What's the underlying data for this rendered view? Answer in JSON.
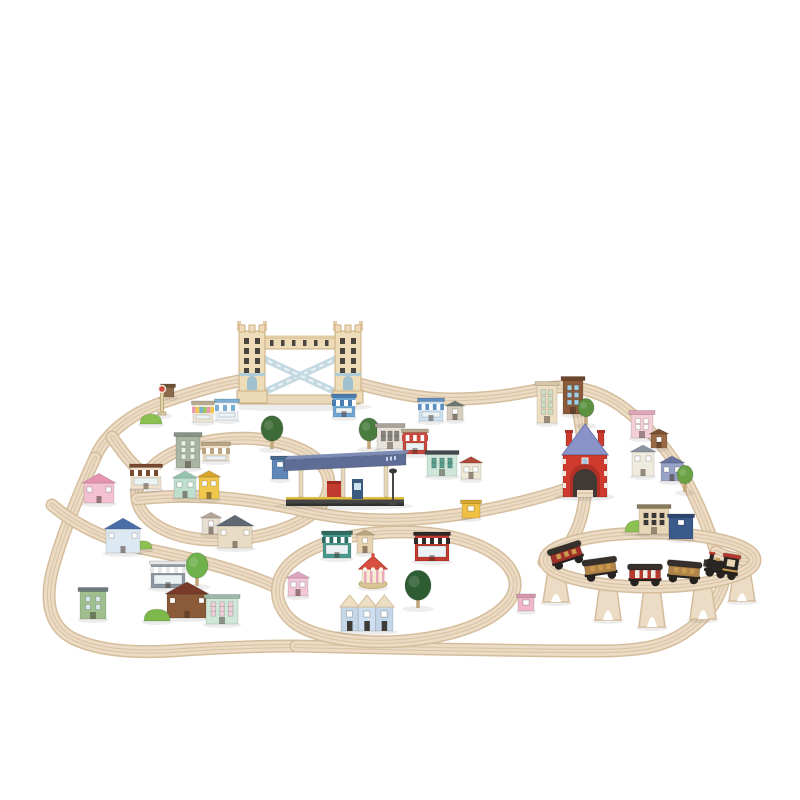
{
  "background": "#ffffff",
  "palette": {
    "background": "#ffffff",
    "track_base": "#ecdcc5",
    "track_edge": "#d5bd9c",
    "track_groove": "#dcc6a8",
    "shadow": "rgba(0,0,0,0.07)",
    "bridge_cream": "#eedbb8",
    "bridge_trim": "#c9ae82",
    "bridge_blue": "#aeccd6",
    "bascule_blue": "#c5d9e2",
    "station_red": "#ce3a2e",
    "station_red_dark": "#b02f26",
    "station_roof_blue": "#8a93c8",
    "platform_canopy": "#5d6d95",
    "platform_canopy_top": "#7c8cb4",
    "platform_base": "#454545",
    "platform_stripe": "#e2bc3c",
    "train_black": "#2a2623",
    "train_red": "#b5392e",
    "train_gold": "#c89b4e",
    "window_dark": "#4a4440",
    "foliage_light": "#8cc152"
  },
  "scene": {
    "canvas": {
      "width": 800,
      "height": 800
    },
    "tracks": [
      {
        "n": "top-left-curve",
        "d": "M 95 458 C 104 436 128 414 164 402 C 198 390 228 382 252 379"
      },
      {
        "n": "top-right-run",
        "d": "M 348 381 C 388 392 420 399 452 399 C 498 399 524 392 548 388 C 574 384 598 391 618 404 C 648 425 669 451 684 477 C 698 502 708 527 716 552"
      },
      {
        "n": "left-outer-loop",
        "d": "M 95 458 C 82 486 62 534 52 572 C 45 602 50 626 72 638 C 98 651 134 653 170 651 C 214 648 254 646 296 646"
      },
      {
        "n": "bottom-run",
        "d": "M 296 646 C 390 648 500 651 598 651 C 642 651 664 646 684 633 C 704 620 716 604 722 587 C 727 571 724 559 716 552"
      },
      {
        "n": "right-connector",
        "d": "M 716 552 C 724 556 736 560 747 560"
      },
      {
        "n": "inner-left-loop",
        "d": "M 146 474 C 170 442 236 430 286 444 C 320 454 336 474 326 497 C 314 524 262 541 212 540 C 168 539 140 520 137 499 C 135 489 139 481 146 474 Z"
      },
      {
        "n": "middle-run",
        "d": "M 137 499 C 200 492 258 500 305 511 C 362 524 420 521 468 513 C 514 505 546 496 567 489"
      },
      {
        "n": "junction-curve",
        "d": "M 112 437 C 122 452 130 462 140 471"
      },
      {
        "n": "left-diagonal",
        "d": "M 52 505 C 75 525 110 542 150 550 C 200 560 245 572 278 588"
      },
      {
        "n": "bottom-oval",
        "d": "M 278 585 C 282 556 330 534 392 532 C 452 530 504 548 514 577 C 522 602 488 628 428 638 C 372 647 308 640 288 617 C 280 608 276 597 278 585 Z"
      },
      {
        "n": "station-climb",
        "d": "M 585 470 C 585 452 581 420 575 396"
      },
      {
        "n": "station-descent",
        "d": "M 585 497 C 583 515 578 532 568 545 C 560 555 551 561 544 562"
      },
      {
        "n": "elevated-loop",
        "raised": true,
        "d": "M 545 560 a 105 27 0 1 0 210 0 a 105 27 0 1 0 -210 0"
      }
    ],
    "items": [
      {
        "t": "riser",
        "n": "track-riser",
        "x": 556,
        "y": 602,
        "h": 32
      },
      {
        "t": "riser",
        "n": "track-riser",
        "x": 608,
        "y": 620,
        "h": 38
      },
      {
        "t": "riser",
        "n": "track-riser",
        "x": 652,
        "y": 627,
        "h": 40
      },
      {
        "t": "riser",
        "n": "track-riser",
        "x": 703,
        "y": 619,
        "h": 36
      },
      {
        "t": "riser",
        "n": "track-riser",
        "x": 742,
        "y": 601,
        "h": 31
      },
      {
        "t": "bridge",
        "n": "tower-bridge",
        "x": 300,
        "y": 403
      },
      {
        "t": "redstation",
        "n": "red-tunnel-station",
        "x": 585,
        "y": 497
      },
      {
        "t": "platform",
        "n": "station-platform",
        "x": 344,
        "y": 506
      },
      {
        "t": "carousel",
        "n": "bandstand",
        "x": 373,
        "y": 587
      },
      {
        "t": "rowhouses",
        "n": "terrace-houses",
        "x": 367,
        "y": 631
      },
      {
        "t": "signal",
        "n": "rail-signal",
        "x": 162,
        "y": 415
      },
      {
        "t": "tree",
        "n": "tree",
        "x": 272,
        "y": 449,
        "r": 11,
        "c1": "#3e6b37"
      },
      {
        "t": "tree",
        "n": "tree",
        "x": 369,
        "y": 449,
        "r": 10,
        "c1": "#497c3e"
      },
      {
        "t": "tree",
        "n": "tree",
        "x": 418,
        "y": 608,
        "r": 13,
        "c1": "#2e5d33"
      },
      {
        "t": "tree",
        "n": "tree",
        "x": 586,
        "y": 425,
        "r": 8,
        "c1": "#5b9141"
      },
      {
        "t": "tree",
        "n": "tree",
        "x": 685,
        "y": 492,
        "r": 8,
        "c1": "#6ba245"
      },
      {
        "t": "tree",
        "n": "round-tree",
        "x": 197,
        "y": 586,
        "r": 11,
        "c1": "#6fb14b"
      },
      {
        "t": "bush",
        "n": "bush",
        "x": 151,
        "y": 424,
        "w": 22,
        "c1": "#8cc152"
      },
      {
        "t": "bush",
        "n": "bush",
        "x": 157,
        "y": 621,
        "w": 26,
        "c1": "#7cb84a"
      },
      {
        "t": "bush",
        "n": "bush",
        "x": 638,
        "y": 532,
        "w": 26,
        "c1": "#8cc152"
      },
      {
        "t": "bush",
        "n": "bush",
        "x": 143,
        "y": 549,
        "w": 18,
        "c1": "#8cc152"
      },
      {
        "t": "house",
        "n": "pink-house",
        "x": 99,
        "y": 503,
        "w": 30,
        "h": 20,
        "c1": "#f3c1d2",
        "c2": "#e693b2"
      },
      {
        "t": "shop",
        "n": "bakery-shop",
        "x": 146,
        "y": 489,
        "w": 30,
        "h": 22,
        "c1": "#f0e2cd",
        "c2": "#7a4a2e"
      },
      {
        "t": "block",
        "n": "general-store",
        "x": 188,
        "y": 468,
        "w": 24,
        "h": 32,
        "c1": "#a9b4a3",
        "c2": "#879283",
        "c3": "#e8f0e6",
        "rows": 3,
        "cols": 2
      },
      {
        "t": "shop",
        "n": "tan-shop",
        "x": 216,
        "y": 461,
        "w": 26,
        "h": 16,
        "c1": "#eedfc7",
        "c2": "#b9a582"
      },
      {
        "t": "house",
        "n": "mint-house",
        "x": 185,
        "y": 498,
        "w": 22,
        "h": 20,
        "c1": "#bfe0cf",
        "c2": "#96c5af"
      },
      {
        "t": "house",
        "n": "yellow-house",
        "x": 209,
        "y": 499,
        "w": 20,
        "h": 22,
        "c1": "#efc84d",
        "c2": "#d8a630"
      },
      {
        "t": "house",
        "n": "blue-roof-house",
        "x": 123,
        "y": 553,
        "w": 34,
        "h": 24,
        "c1": "#dde9f2",
        "c2": "#4a6fa8"
      },
      {
        "t": "house",
        "n": "small-white-house",
        "x": 211,
        "y": 534,
        "w": 18,
        "h": 16,
        "c1": "#e7dfd2",
        "c2": "#b4a795"
      },
      {
        "t": "house",
        "n": "gray-roof-cottage",
        "x": 235,
        "y": 548,
        "w": 34,
        "h": 22,
        "c1": "#e9dcc4",
        "c2": "#5e6973"
      },
      {
        "t": "block",
        "n": "green-kiosk",
        "x": 93,
        "y": 619,
        "w": 26,
        "h": 28,
        "c1": "#9fbf8e",
        "c2": "#6f7a80",
        "c3": "#dce8f0",
        "rows": 2,
        "cols": 2
      },
      {
        "t": "shop",
        "n": "gray-shop",
        "x": 168,
        "y": 588,
        "w": 34,
        "h": 24,
        "c1": "#8f99a3",
        "c2": "#e8e8ea"
      },
      {
        "t": "house",
        "n": "red-roof-house",
        "x": 187,
        "y": 618,
        "w": 40,
        "h": 24,
        "c1": "#8a5a39",
        "c2": "#7a3a2a"
      },
      {
        "t": "block",
        "n": "mint-market",
        "x": 222,
        "y": 624,
        "w": 32,
        "h": 26,
        "c1": "#cfe7d8",
        "c2": "#9eb7a7",
        "c3": "#f0d0da",
        "rows": 3,
        "cols": 3
      },
      {
        "t": "shop",
        "n": "rainbow-awning-shop",
        "x": 203,
        "y": 422,
        "w": 20,
        "h": 18,
        "c1": "#f1e9d7",
        "c2": [
          "#e89ab5",
          "#f0c84a",
          "#7ab0d4",
          "#9ac85e"
        ]
      },
      {
        "t": "shop",
        "n": "blue-awning-shop",
        "x": 227,
        "y": 420,
        "w": 22,
        "h": 18,
        "c1": "#eef3f7",
        "c2": "#79afd3"
      },
      {
        "t": "shop",
        "n": "blue-bank",
        "x": 344,
        "y": 417,
        "w": 22,
        "h": 20,
        "c1": "#6fa7d7",
        "c2": "#4a7cb0"
      },
      {
        "t": "shop",
        "n": "blue-white-shop",
        "x": 431,
        "y": 421,
        "w": 24,
        "h": 20,
        "c1": "#cfe3f3",
        "c2": "#5f8fc0"
      },
      {
        "t": "house",
        "n": "small-gray-house",
        "x": 455,
        "y": 420,
        "w": 16,
        "h": 14,
        "c1": "#d7cebf",
        "c2": "#6f7973"
      },
      {
        "t": "block",
        "n": "museum",
        "x": 390,
        "y": 449,
        "w": 26,
        "h": 22,
        "c1": "#e7e3db",
        "c2": "#a7a39b",
        "c3": "#8a867e",
        "rows": 2,
        "cols": 3
      },
      {
        "t": "shop",
        "n": "butcher-shop",
        "x": 415,
        "y": 454,
        "w": 24,
        "h": 22,
        "c1": "#c84a3e",
        "c2": [
          "#c84a3e",
          "#ffffff"
        ]
      },
      {
        "t": "block",
        "n": "dark-roof-store",
        "x": 442,
        "y": 476,
        "w": 30,
        "h": 22,
        "c1": "#cfe7db",
        "c2": "#44494f",
        "c3": "#5a9e8e",
        "rows": 2,
        "cols": 3
      },
      {
        "t": "house",
        "n": "red-roof-cottage",
        "x": 471,
        "y": 479,
        "w": 20,
        "h": 16,
        "c1": "#efe9d7",
        "c2": "#af4a3a"
      },
      {
        "t": "cube",
        "n": "yellow-hut",
        "x": 471,
        "y": 518,
        "w": 18,
        "h": 15,
        "c1": "#efc043",
        "c2": "#d7a72f"
      },
      {
        "t": "cube",
        "n": "ticket-kiosk",
        "x": 280,
        "y": 479,
        "w": 16,
        "h": 20,
        "c1": "#5f87b7",
        "c2": "#48688c"
      },
      {
        "t": "block",
        "n": "cream-tower",
        "x": 547,
        "y": 423,
        "w": 20,
        "h": 38,
        "c1": "#eedfc3",
        "c2": "#d7c7a7",
        "c3": "#cfe0c8",
        "rows": 4,
        "cols": 2
      },
      {
        "t": "block",
        "n": "brown-tower",
        "x": 573,
        "y": 414,
        "w": 20,
        "h": 34,
        "c1": "#8a5a3a",
        "c2": "#6e462c",
        "c3": "#9fd0e8",
        "rows": 3,
        "cols": 2
      },
      {
        "t": "block",
        "n": "pink-boutique",
        "x": 642,
        "y": 438,
        "w": 22,
        "h": 24,
        "c1": "#f3ced7",
        "c2": "#dfa7b7",
        "c3": "#ffffff",
        "rows": 2,
        "cols": 2
      },
      {
        "t": "house",
        "n": "small-brown-house",
        "x": 659,
        "y": 448,
        "w": 16,
        "h": 14,
        "c1": "#9a6a44",
        "c2": "#7a5234"
      },
      {
        "t": "house",
        "n": "white-house",
        "x": 643,
        "y": 476,
        "w": 22,
        "h": 24,
        "c1": "#efebdf",
        "c2": "#8a939f"
      },
      {
        "t": "house",
        "n": "purple-house",
        "x": 672,
        "y": 481,
        "w": 22,
        "h": 18,
        "c1": "#99a3c7",
        "c2": "#6973a0"
      },
      {
        "t": "block",
        "n": "arcade-building",
        "x": 654,
        "y": 534,
        "w": 30,
        "h": 26,
        "c1": "#e7d7b7",
        "c2": "#8a7a5c",
        "c3": "#3a3a3a",
        "rows": 2,
        "cols": 3
      },
      {
        "t": "cube",
        "n": "blue-arcade",
        "x": 681,
        "y": 539,
        "w": 24,
        "h": 22,
        "c1": "#3a5a8c",
        "c2": "#2c4670"
      },
      {
        "t": "shop",
        "n": "teal-shop",
        "x": 337,
        "y": 558,
        "w": 28,
        "h": 24,
        "c1": "#4a9b8e",
        "c2": "#2f6b60"
      },
      {
        "t": "house",
        "n": "small-tan-house",
        "x": 365,
        "y": 553,
        "w": 16,
        "h": 18,
        "c1": "#e7d3af",
        "c2": "#bfa77f"
      },
      {
        "t": "shop",
        "n": "red-theatre",
        "x": 432,
        "y": 561,
        "w": 34,
        "h": 26,
        "c1": "#c03a30",
        "c2": "#2e2a28"
      },
      {
        "t": "house",
        "n": "small-pink-house",
        "x": 298,
        "y": 596,
        "w": 20,
        "h": 18,
        "c1": "#f2c7d7",
        "c2": "#dfa7bf"
      },
      {
        "t": "cube",
        "n": "pink-hut",
        "x": 526,
        "y": 611,
        "w": 16,
        "h": 14,
        "c1": "#efb7c7",
        "c2": "#d797af"
      },
      {
        "t": "cube",
        "n": "signal-box",
        "x": 168,
        "y": 397,
        "w": 12,
        "h": 10,
        "c1": "#8a6a4a",
        "c2": "#6e5238"
      },
      {
        "t": "car",
        "n": "caboose-wagon",
        "x": 570,
        "y": 566,
        "a": -18,
        "c1": "#9e3028",
        "st": 0
      },
      {
        "t": "car",
        "n": "freight-wagon",
        "x": 602,
        "y": 580,
        "a": -8,
        "c1": "#b08448",
        "st": 0
      },
      {
        "t": "car",
        "n": "striped-wagon",
        "x": 645,
        "y": 586,
        "a": 0,
        "c1": "#b5392e",
        "st": 1
      },
      {
        "t": "car",
        "n": "coach-wagon",
        "x": 683,
        "y": 583,
        "a": 5,
        "c1": "#b08448",
        "st": 0
      },
      {
        "t": "engine",
        "n": "locomotive",
        "x": 720,
        "y": 578,
        "a": 9
      }
    ]
  }
}
